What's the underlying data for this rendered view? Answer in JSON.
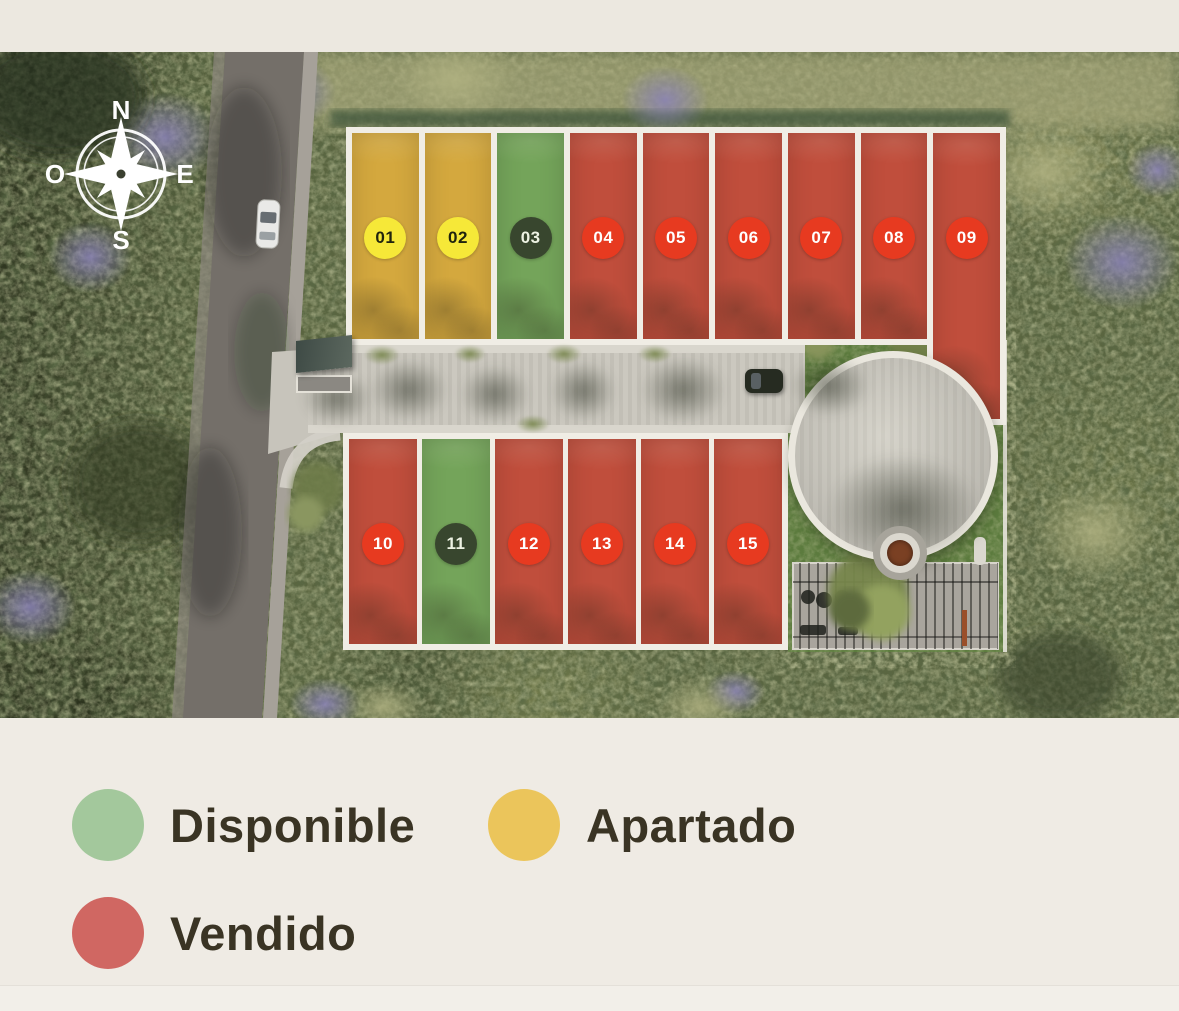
{
  "compass": {
    "north": "N",
    "east": "E",
    "south": "S",
    "west": "O"
  },
  "site_plan": {
    "top_row": [
      {
        "number": "01",
        "status": "apartado"
      },
      {
        "number": "02",
        "status": "apartado"
      },
      {
        "number": "03",
        "status": "disponible"
      },
      {
        "number": "04",
        "status": "vendido"
      },
      {
        "number": "05",
        "status": "vendido"
      },
      {
        "number": "06",
        "status": "vendido"
      },
      {
        "number": "07",
        "status": "vendido"
      },
      {
        "number": "08",
        "status": "vendido"
      },
      {
        "number": "09",
        "status": "vendido"
      }
    ],
    "bottom_row": [
      {
        "number": "10",
        "status": "vendido"
      },
      {
        "number": "11",
        "status": "disponible"
      },
      {
        "number": "12",
        "status": "vendido"
      },
      {
        "number": "13",
        "status": "vendido"
      },
      {
        "number": "14",
        "status": "vendido"
      },
      {
        "number": "15",
        "status": "vendido"
      }
    ]
  },
  "legend": {
    "items": [
      {
        "label": "Disponible",
        "status": "disponible",
        "color": "#a3c89c"
      },
      {
        "label": "Apartado",
        "status": "apartado",
        "color": "#ebc55b"
      },
      {
        "label": "Vendido",
        "status": "vendido",
        "color": "#d06762"
      }
    ]
  },
  "colors": {
    "lot_apartado": "#d4a83e",
    "lot_disponible": "#74a45a",
    "lot_vendido": "#c04e3c",
    "badge_apartado_bg": "#f6e838",
    "badge_apartado_text": "#20240e",
    "badge_disponible_bg": "#38462e",
    "badge_disponible_text": "#edf2e3",
    "badge_vendido_bg": "#e73a20",
    "badge_vendido_text": "#ffffff"
  }
}
